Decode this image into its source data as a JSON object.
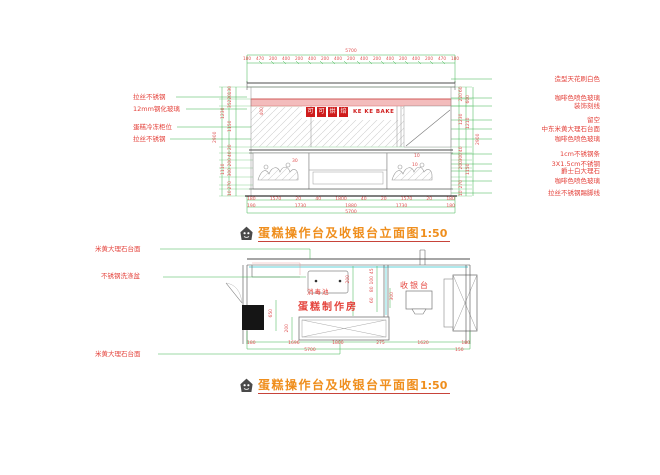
{
  "colors": {
    "dim_green": "#3cb54e",
    "dim_text_red": "#e05151",
    "label_red": "#e4433c",
    "title_orange": "#ef8e1c",
    "underline_red": "#c7433a",
    "line_dark": "#4d4d4d",
    "cyan": "#2cc5ce",
    "band_pink": "#f3bcbc",
    "sign_red": "#cf1d1d"
  },
  "elevation": {
    "title": "蛋糕操作台及收银台立面图",
    "scale": "1:50",
    "total_width_dim": "5700",
    "top_dims": [
      "180",
      "470",
      "200",
      "400",
      "200",
      "400",
      "200",
      "400",
      "200",
      "400",
      "200",
      "400",
      "200",
      "400",
      "200",
      "470",
      "180"
    ],
    "sign_chars": [
      "可",
      "可",
      "烘",
      "焙"
    ],
    "sign_latin": "KE KE BAKE",
    "left_labels": [
      "拉丝不锈钢",
      "12mm钢化玻璃",
      "蛋糕冷冻柜位",
      "拉丝不锈钢"
    ],
    "right_labels": [
      "造型天花刷白色",
      "咖啡色喷色玻璃",
      "装饰刻线",
      "留空",
      "中东米黄大理石台面",
      "咖啡色喷色玻璃",
      "1cm不锈钢条",
      "3X1.5cm不锈钢",
      "爵士白大理石",
      "咖啡色喷色玻璃",
      "拉丝不锈钢踢脚线"
    ],
    "left_total_dim": "2900",
    "left_dims_outer": [
      "1230",
      "1110"
    ],
    "left_dims_inner": [
      "130",
      "220",
      "35",
      "1150",
      "20",
      "40",
      "200",
      "300",
      "270",
      "10"
    ],
    "right_total_dim": "2900",
    "right_dims_outer": [
      "600",
      "1210",
      "1150"
    ],
    "right_dims_inner": [
      "60",
      "220",
      "1230",
      "40",
      "300",
      "200",
      "270",
      "10"
    ],
    "inner_dims": {
      "glass_height": "400",
      "d30": "30",
      "d10a": "10",
      "d10b": "10"
    },
    "bottom_dims_row1": [
      "180",
      "1570",
      "20",
      "40",
      "1800",
      "40",
      "20",
      "1570",
      "20",
      "180"
    ],
    "bottom_dims_row2": [
      "190",
      "1730",
      "1880",
      "1730",
      "180"
    ],
    "bottom_total_dim": "5700"
  },
  "plan": {
    "title": "蛋糕操作台及收银台平面图",
    "scale": "1:50",
    "room_label": "蛋糕制作房",
    "cashier_label": "收银台",
    "sanitize_label": "消毒池",
    "left_labels": [
      "米黄大理石台面",
      "不锈钢洗涤盆",
      "米黄大理石台面"
    ],
    "column_dim": "650",
    "counter_dim": "200",
    "mid_dims_a": [
      "45",
      "100",
      "80",
      "60"
    ],
    "mid_dim_200": "200",
    "mid_dim_300": "300",
    "bottom_dims_row1": [
      "180",
      "1696",
      "1800",
      "275",
      "1620",
      "180"
    ],
    "bottom_total_dim": "5700",
    "bottom_right_dim": "150"
  }
}
